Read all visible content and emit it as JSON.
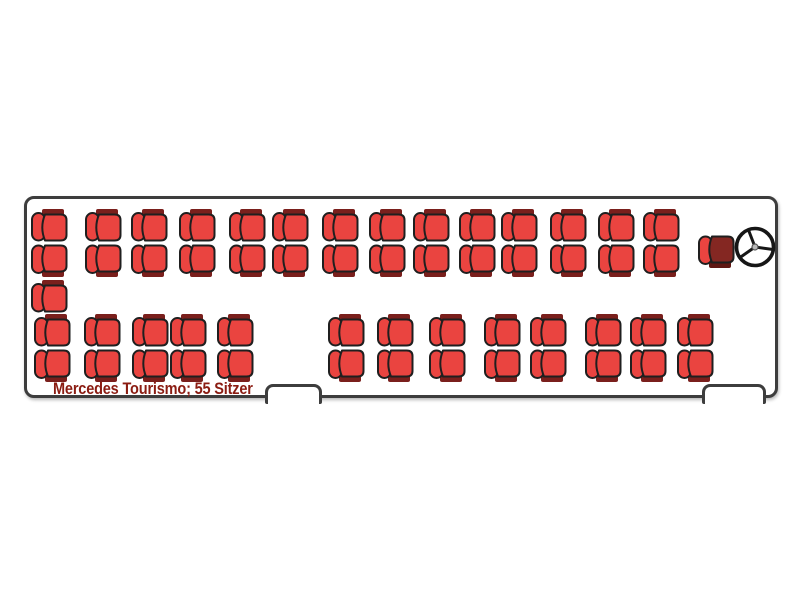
{
  "diagram": {
    "label": "Mercedes Tourismo; 55 Sitzer",
    "vehicle_model": "Mercedes Tourismo",
    "passenger_seat_count": 55,
    "orientation": "front-right"
  },
  "colors": {
    "seat_red": "#ea4440",
    "seat_band_dark": "#7a1f1c",
    "seat_outline": "#1f1f1f",
    "driver_seat_body": "#842722",
    "driver_seat_accent": "#ea4440",
    "driver_seat_band": "#5f1713",
    "bus_outline": "#3d3d3d",
    "label_text": "#8b1c12",
    "background": "#ffffff"
  },
  "seating_summary": {
    "sections": [
      {
        "name": "driver-side-double-row",
        "rows": 2,
        "columns": 14,
        "seats": 28
      },
      {
        "name": "rear-left-single-seat",
        "rows": 1,
        "columns": 1,
        "seats": 1
      },
      {
        "name": "door-side-double-row",
        "rows": 2,
        "columns": 13,
        "seats": 26
      }
    ],
    "driver_seats": 1,
    "total_passenger_seats": 55
  },
  "layout": {
    "bus": {
      "x": 24,
      "y": 196,
      "width": 754,
      "height": 202
    },
    "seat_size": {
      "width": 38,
      "height": 34
    },
    "rows": [
      {
        "name": "driver-side-window-row",
        "variant": "band-top",
        "y": 10,
        "xs": [
          4,
          58,
          104,
          152,
          202,
          245,
          295,
          342,
          386,
          432,
          474,
          523,
          571,
          616
        ]
      },
      {
        "name": "driver-side-aisle-row",
        "variant": "band-bottom",
        "y": 44,
        "xs": [
          4,
          58,
          104,
          152,
          202,
          245,
          295,
          342,
          386,
          432,
          474,
          523,
          571,
          616
        ]
      },
      {
        "name": "rear-left-single",
        "variant": "band-top",
        "y": 81,
        "xs": [
          4
        ]
      },
      {
        "name": "door-side-aisle-row",
        "variant": "band-top",
        "y": 115,
        "xs": [
          7,
          57,
          105,
          143,
          190,
          301,
          350,
          402,
          457,
          503,
          558,
          603,
          650
        ]
      },
      {
        "name": "door-side-window-row",
        "variant": "band-bottom",
        "y": 149,
        "xs": [
          7,
          57,
          105,
          143,
          190,
          301,
          350,
          402,
          457,
          503,
          558,
          603,
          650
        ]
      }
    ],
    "driver_seat": {
      "x": 671,
      "y": 35,
      "variant": "band-bottom"
    },
    "steering_wheel": {
      "x": 705,
      "y": 25,
      "size": 46
    },
    "doors": [
      {
        "name": "middle-door",
        "x": 238,
        "y": 185,
        "width": 57,
        "height": 17
      },
      {
        "name": "front-door",
        "x": 675,
        "y": 185,
        "width": 64,
        "height": 17
      }
    ],
    "label_pos": {
      "x": 26,
      "y": 181
    }
  }
}
